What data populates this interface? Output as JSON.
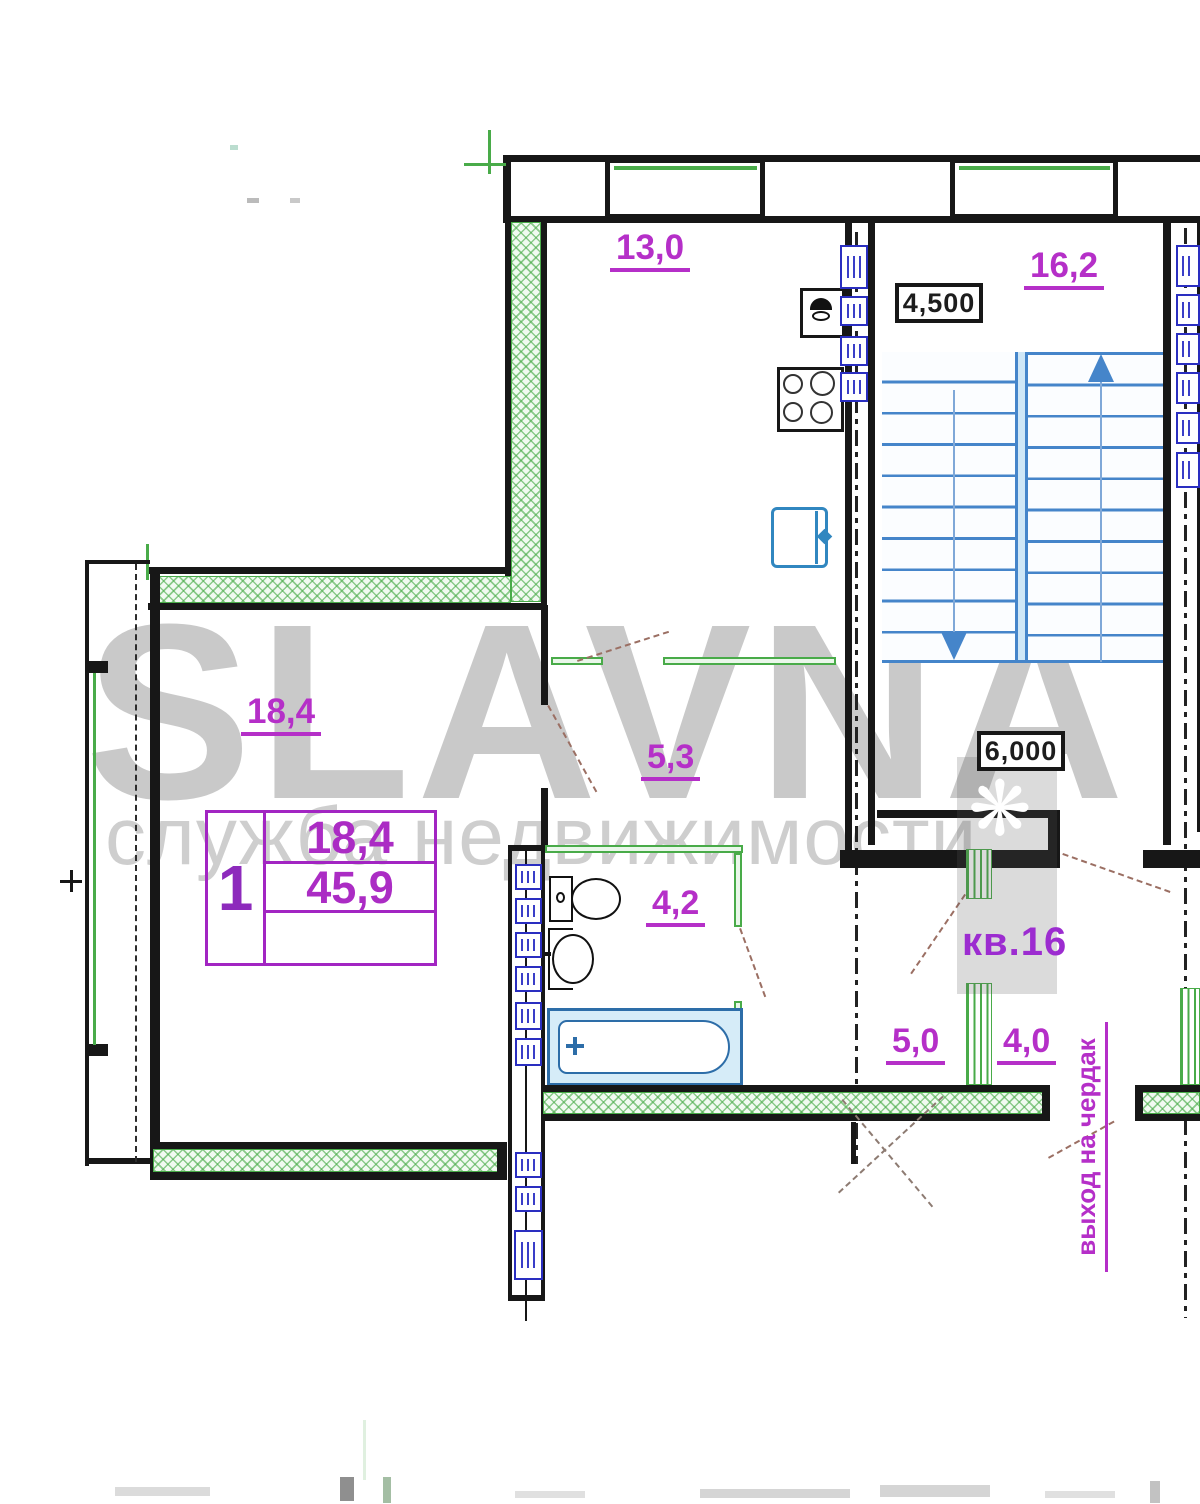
{
  "watermark": {
    "brand": "SLAVNA",
    "tagline": "служба недвижимости",
    "ornament_glyph": "❋"
  },
  "plan": {
    "areas": {
      "kitchen": "13,0",
      "stair_hall": "16,2",
      "living_room": "18,4",
      "hallway": "5,3",
      "bathroom": "4,2",
      "corridor": "5,0",
      "storage": "4,0"
    },
    "apartment_number": "кв.16",
    "attic_exit": "выход на чердак",
    "elevations": {
      "upper": "4,500",
      "lower": "6,000"
    }
  },
  "info_table": {
    "room_count": "1",
    "living_area": "18,4",
    "total_area": "45,9",
    "note": ""
  },
  "colors": {
    "label_magenta": "#b52fc8",
    "wall_black": "#171717",
    "green_wall": "#49ab49",
    "stairs_blue": "#4585ca",
    "fixture_blue": "#2d6da8",
    "riser_blue": "#2a2ec0",
    "door_swing_brown": "#9b6f63",
    "watermark_gray": "#c9c9c9"
  }
}
